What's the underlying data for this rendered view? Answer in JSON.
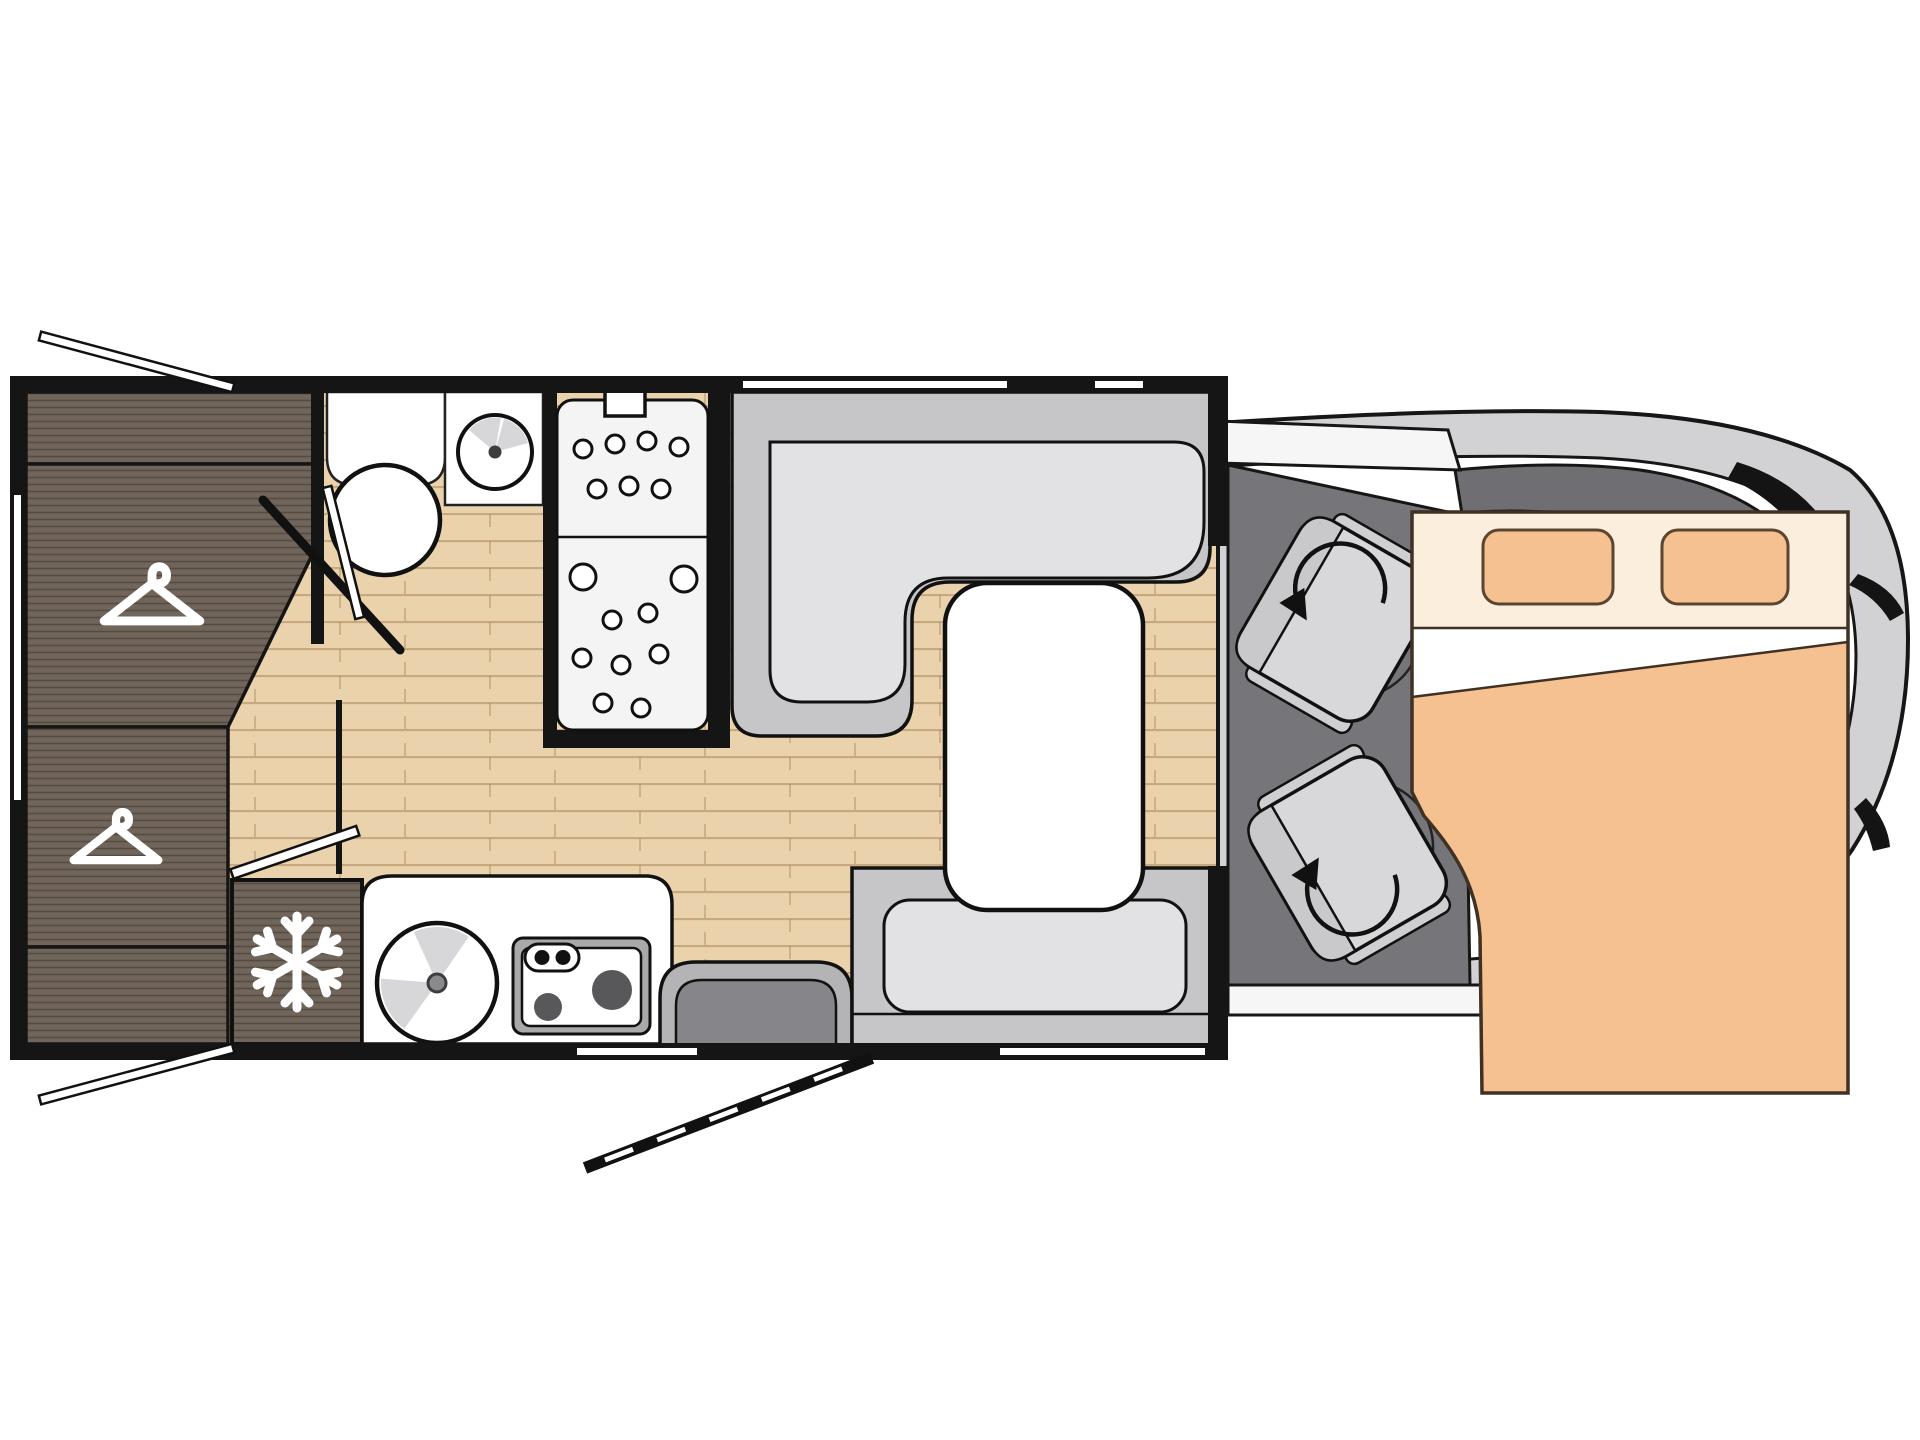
{
  "page": {
    "title": "Motorhome floor plan (top view)",
    "background": "#ffffff"
  },
  "icons": {
    "hanger": "clothes-hanger-icon",
    "snowflake": "snowflake-icon",
    "rotation_arrow": "swivel-arrow-icon"
  },
  "colors": {
    "wall": "#151515",
    "floor_wood": "#ead2ad",
    "floor_grain": "#a48052",
    "dark_wood": "#6f6459",
    "white": "#ffffff",
    "seat_outer": "#c6c6c8",
    "seat_cushion": "#e2e2e4",
    "cab_floor": "#76767a",
    "cab_body": "#d2d2d4",
    "windshield_band": "#6f6f73",
    "bed_peach": "#f5c191",
    "bed_headboard": "#fbeedd",
    "step_dark": "#86868a",
    "step_frame": "#b4b4b6"
  },
  "zones": {
    "rear_wardrobe": {
      "sections": 4,
      "hanger_icons": 2
    },
    "bathroom": {
      "fixtures": [
        "toilet",
        "washbasin",
        "shower"
      ],
      "shower_panels": 2
    },
    "kitchen": {
      "fixtures": [
        "fridge",
        "sink",
        "stove"
      ],
      "stove_burners": 2
    },
    "dinette": {
      "fixtures": [
        "l-shaped-sofa",
        "bench-seat",
        "table"
      ]
    },
    "entry": {
      "fixtures": [
        "entry-step",
        "door-swing"
      ]
    },
    "cab": {
      "swivel_seats": 2,
      "rotation_arrows": 2
    },
    "drop_down_bed": {
      "pillows": 2,
      "over": "cab"
    }
  }
}
